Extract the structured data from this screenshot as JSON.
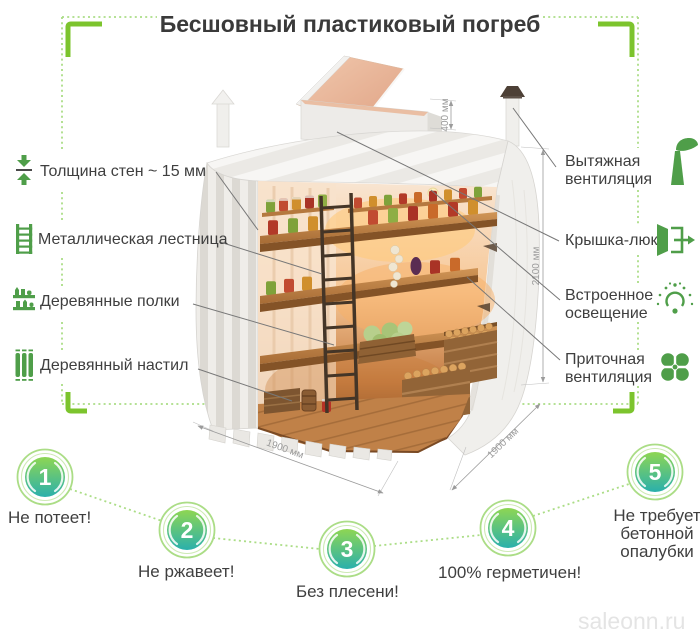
{
  "title": "Бесшовный пластиковый погреб",
  "watermark": "saleonn.ru",
  "colors": {
    "accent_green": "#7cc42d",
    "dotted_green": "#abdd86",
    "icon_green": "#4f9e49",
    "text_dark": "#3f3f3f",
    "dim_gray": "#9b9b9b",
    "watermark_gray": "#e4e4e4",
    "circle_gradient_top": "#8ed653",
    "circle_gradient_bottom": "#2ab0ac"
  },
  "left_labels": [
    {
      "icon": "wall-thickness-icon",
      "text": "Толщина стен ~ 15 мм"
    },
    {
      "icon": "ladder-icon",
      "text": "Металлическая лестница"
    },
    {
      "icon": "shelves-icon",
      "text": "Деревянные полки"
    },
    {
      "icon": "decking-icon",
      "text": "Деревянный настил"
    }
  ],
  "right_labels": [
    {
      "icon": "exhaust-vent-icon",
      "lines": [
        "Вытяжная",
        "вентиляция"
      ]
    },
    {
      "icon": "hatch-icon",
      "lines": [
        "Крышка-люк"
      ]
    },
    {
      "icon": "light-icon",
      "lines": [
        "Встроенное",
        "освещение"
      ]
    },
    {
      "icon": "supply-vent-icon",
      "lines": [
        "Приточная",
        "вентиляция"
      ]
    }
  ],
  "dimensions": {
    "hatch_height": "400 мм",
    "inner_height": "2100 мм",
    "width": "1900 мм",
    "depth": "1900 мм"
  },
  "benefits": [
    {
      "number": "1",
      "lines": [
        "Не потеет!"
      ]
    },
    {
      "number": "2",
      "lines": [
        "Не ржавеет!"
      ]
    },
    {
      "number": "3",
      "lines": [
        "Без плесени!"
      ]
    },
    {
      "number": "4",
      "lines": [
        "100% герметичен!"
      ]
    },
    {
      "number": "5",
      "lines": [
        "Не требует",
        "бетонной",
        "опалубки"
      ]
    }
  ]
}
